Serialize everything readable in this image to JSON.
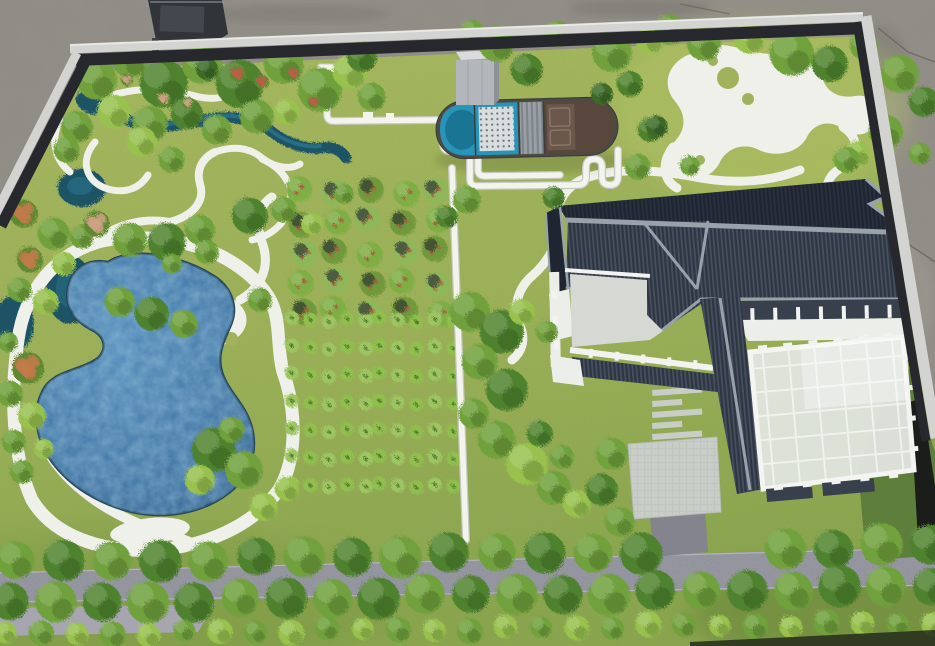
{
  "meta": {
    "kind": "photograph",
    "subject": "architectural-landscape-scale-model",
    "description": "Top-down photo of a physical sand-table model: lake with white shore paths, tree groves, orchard and crop plots, sewage-treatment basin with white PVC piping, grey-tile courtyard building with greenhouse, tree-lined road, aluminum model frame on concrete floor"
  },
  "scene": {
    "colors": {
      "floor": "#908c85",
      "floorDark": "#7d7972",
      "floorLight": "#9c988f",
      "frameSilver": "#d3d4d1",
      "frameDark": "#26282d",
      "grass": "#a0b35c",
      "grassDeep": "#86a14c",
      "grassBright": "#b7c768",
      "path": "#eef0e9",
      "road": "#8d8e98",
      "roadLight": "#a7a6b0",
      "drive": "#83848d",
      "pond": "#3d74a4",
      "pondLight": "#5d93bd",
      "pondDeep": "#2c5d88",
      "stream": "#1d5365",
      "streamLight": "#2f7e98",
      "roofDark": "#1f2531",
      "roofSlope": "#2e3644",
      "ridge": "#99a1ab",
      "wall": "#eceee9",
      "terrace": "#d6d8d3",
      "glass": "#e2e5e0",
      "darkBand": "#39404d",
      "basinRim": "#4c4a45",
      "basinBlue": "#2795ba",
      "basinWater": "#1a7494",
      "diffuser": "#d9dddf",
      "filterGray": "#9aa0a5",
      "brown": "#6b574b",
      "brownDark": "#59463c",
      "panel": "#8a7666",
      "pipe": "#f4f4ef",
      "pipeShadow": "#c7c7c1",
      "tower": "#b3b7bb",
      "towerTop": "#d9dbdc",
      "towerSide": "#8e9296",
      "treeL": "#98c14e",
      "treeM": "#6fa13c",
      "treeD": "#4f822e",
      "treeDD": "#3c6b28",
      "flowerO": "#c27a4a",
      "flowerT": "#cfa284",
      "flowerR": "#bf5b48",
      "cropA": "#7fae44",
      "cropB": "#8fbf4d",
      "cropDot": "#a5643f",
      "edgeGreen": "#5e7f3c",
      "edgeBlack": "#1a1d1a",
      "object": "#313439"
    },
    "treeVariants": {
      "l": "treeL",
      "m": "treeM",
      "d": "treeD",
      "dd": "treeDD",
      "fo": "flowerO",
      "ft": "flowerT",
      "fr": "flowerR"
    },
    "trees": {
      "scattered": [
        [
          95,
          78,
          20,
          "m"
        ],
        [
          128,
          58,
          18,
          "m"
        ],
        [
          162,
          82,
          24,
          "d"
        ],
        [
          200,
          62,
          20,
          "m"
        ],
        [
          205,
          67,
          11,
          "dd"
        ],
        [
          238,
          82,
          24,
          "d"
        ],
        [
          282,
          62,
          20,
          "m"
        ],
        [
          318,
          88,
          22,
          "m"
        ],
        [
          348,
          70,
          17,
          "l"
        ],
        [
          370,
          95,
          14,
          "m"
        ],
        [
          75,
          125,
          16,
          "m"
        ],
        [
          112,
          110,
          17,
          "l"
        ],
        [
          148,
          122,
          18,
          "m"
        ],
        [
          185,
          112,
          16,
          "d"
        ],
        [
          215,
          128,
          15,
          "m"
        ],
        [
          255,
          115,
          17,
          "m"
        ],
        [
          65,
          148,
          13,
          "m"
        ],
        [
          140,
          140,
          15,
          "l"
        ],
        [
          170,
          158,
          13,
          "m"
        ],
        [
          285,
          110,
          13,
          "l"
        ],
        [
          236,
          72,
          8,
          "fr"
        ],
        [
          260,
          80,
          7,
          "fr"
        ],
        [
          292,
          72,
          7,
          "fr"
        ],
        [
          162,
          97,
          7,
          "ft"
        ],
        [
          186,
          101,
          6,
          "ft"
        ],
        [
          312,
          100,
          6,
          "fr"
        ],
        [
          125,
          78,
          6,
          "ft"
        ],
        [
          495,
          42,
          18,
          "m"
        ],
        [
          525,
          68,
          16,
          "d"
        ],
        [
          556,
          32,
          13,
          "m"
        ],
        [
          610,
          50,
          20,
          "m"
        ],
        [
          648,
          38,
          14,
          "l"
        ],
        [
          600,
          92,
          11,
          "dd"
        ],
        [
          628,
          82,
          13,
          "d"
        ],
        [
          470,
          30,
          12,
          "m"
        ],
        [
          360,
          55,
          15,
          "d"
        ],
        [
          668,
          28,
          15,
          "m"
        ],
        [
          702,
          42,
          17,
          "m"
        ],
        [
          748,
          36,
          16,
          "l"
        ],
        [
          790,
          52,
          22,
          "m"
        ],
        [
          828,
          62,
          18,
          "d"
        ],
        [
          862,
          44,
          14,
          "m"
        ],
        [
          898,
          72,
          19,
          "m"
        ],
        [
          922,
          100,
          15,
          "d"
        ],
        [
          884,
          130,
          17,
          "m"
        ],
        [
          856,
          152,
          13,
          "l"
        ],
        [
          918,
          152,
          11,
          "m"
        ],
        [
          648,
          128,
          12,
          "d"
        ],
        [
          688,
          164,
          10,
          "m"
        ],
        [
          636,
          165,
          13,
          "m"
        ],
        [
          655,
          125,
          11,
          "dd"
        ],
        [
          845,
          158,
          13,
          "m"
        ],
        [
          22,
          212,
          14,
          "fo"
        ],
        [
          52,
          232,
          16,
          "m"
        ],
        [
          28,
          258,
          13,
          "fo"
        ],
        [
          62,
          262,
          12,
          "l"
        ],
        [
          18,
          288,
          12,
          "m"
        ],
        [
          44,
          300,
          13,
          "l"
        ],
        [
          80,
          235,
          12,
          "m"
        ],
        [
          26,
          366,
          16,
          "fo"
        ],
        [
          8,
          392,
          13,
          "m"
        ],
        [
          30,
          414,
          14,
          "l"
        ],
        [
          12,
          440,
          12,
          "m"
        ],
        [
          42,
          447,
          10,
          "l"
        ],
        [
          20,
          470,
          12,
          "m"
        ],
        [
          6,
          340,
          10,
          "m"
        ],
        [
          95,
          222,
          13,
          "ft"
        ],
        [
          128,
          238,
          17,
          "m"
        ],
        [
          165,
          240,
          19,
          "d"
        ],
        [
          198,
          228,
          15,
          "m"
        ],
        [
          248,
          214,
          18,
          "d"
        ],
        [
          282,
          208,
          13,
          "m"
        ],
        [
          310,
          222,
          11,
          "l"
        ],
        [
          118,
          300,
          15,
          "m"
        ],
        [
          150,
          312,
          17,
          "d"
        ],
        [
          182,
          322,
          14,
          "m"
        ],
        [
          342,
          192,
          10,
          "m"
        ],
        [
          205,
          250,
          12,
          "m"
        ],
        [
          212,
          448,
          22,
          "d"
        ],
        [
          242,
          468,
          19,
          "m"
        ],
        [
          198,
          478,
          15,
          "l"
        ],
        [
          230,
          428,
          13,
          "m"
        ],
        [
          262,
          505,
          14,
          "l"
        ],
        [
          285,
          487,
          12,
          "l"
        ],
        [
          170,
          262,
          10,
          "m"
        ],
        [
          258,
          298,
          12,
          "m"
        ],
        [
          468,
          310,
          20,
          "m"
        ],
        [
          500,
          330,
          22,
          "d"
        ],
        [
          478,
          360,
          18,
          "m"
        ],
        [
          505,
          388,
          21,
          "d"
        ],
        [
          472,
          412,
          15,
          "m"
        ],
        [
          495,
          438,
          19,
          "m"
        ],
        [
          525,
          462,
          21,
          "l"
        ],
        [
          552,
          486,
          17,
          "m"
        ],
        [
          575,
          502,
          14,
          "l"
        ],
        [
          538,
          432,
          13,
          "d"
        ],
        [
          560,
          455,
          12,
          "m"
        ],
        [
          520,
          310,
          13,
          "l"
        ],
        [
          545,
          330,
          11,
          "m"
        ],
        [
          465,
          198,
          14,
          "m"
        ],
        [
          445,
          215,
          11,
          "d"
        ],
        [
          552,
          196,
          11,
          "d"
        ],
        [
          610,
          452,
          16,
          "m"
        ],
        [
          600,
          488,
          16,
          "d"
        ],
        [
          618,
          520,
          15,
          "m"
        ],
        [
          634,
          548,
          12,
          "m"
        ]
      ],
      "rows": [
        {
          "x0": 14,
          "x1": 928,
          "y0": 561,
          "y1": 544,
          "count": 20,
          "r": 20,
          "gap": [
            640,
            745
          ],
          "variants": [
            "m",
            "d"
          ]
        },
        {
          "x0": 8,
          "x1": 930,
          "y0": 602,
          "y1": 585,
          "count": 21,
          "r": 20,
          "gap": null,
          "variants": [
            "d",
            "m"
          ]
        },
        {
          "x0": 4,
          "x1": 932,
          "y0": 633,
          "y1": 621,
          "count": 27,
          "r": 12,
          "gap": null,
          "variants": [
            "l",
            "m"
          ]
        }
      ]
    },
    "crops": {
      "orchard": {
        "x0": 300,
        "y0": 190,
        "cols": 5,
        "rows": 5,
        "dx": 34,
        "dy": 30,
        "r": 13
      },
      "field": {
        "x0": 292,
        "y0": 318,
        "cols": 10,
        "rows": 7,
        "dx": 17.5,
        "dy": 27.6,
        "r": 7
      }
    },
    "posts": [
      {
        "x0": 750,
        "y0": 349,
        "x1": 901,
        "y1": 334,
        "n": 6,
        "w": 9,
        "h": 5
      },
      {
        "x0": 905,
        "y0": 342,
        "x1": 915,
        "y1": 464,
        "n": 4,
        "w": 5,
        "h": 9
      },
      {
        "x0": 764,
        "y0": 489,
        "x1": 908,
        "y1": 474,
        "n": 5,
        "w": 9,
        "h": 5
      },
      {
        "x0": 741,
        "y0": 315,
        "x1": 901,
        "y1": 311,
        "n": 7,
        "w": 4,
        "h": 13
      },
      {
        "x0": 578,
        "y0": 352,
        "x1": 708,
        "y1": 366,
        "n": 5,
        "w": 4,
        "h": 9
      },
      {
        "x0": 554,
        "y0": 282,
        "x1": 557,
        "y1": 358,
        "n": 3,
        "w": 8,
        "h": 5
      }
    ],
    "elements": [
      "concrete-floor",
      "aluminum-frame",
      "grass-base",
      "lake",
      "shore-path",
      "stream",
      "garden-paths",
      "orchard-plot",
      "vegetable-plot",
      "treatment-basin",
      "water-tower",
      "pvc-pipes",
      "irrigation-pipe",
      "main-building-roof",
      "courtyard-terrace",
      "greenhouse",
      "paver-path",
      "driveway",
      "tree-lined-road",
      "hedge-strip"
    ]
  }
}
